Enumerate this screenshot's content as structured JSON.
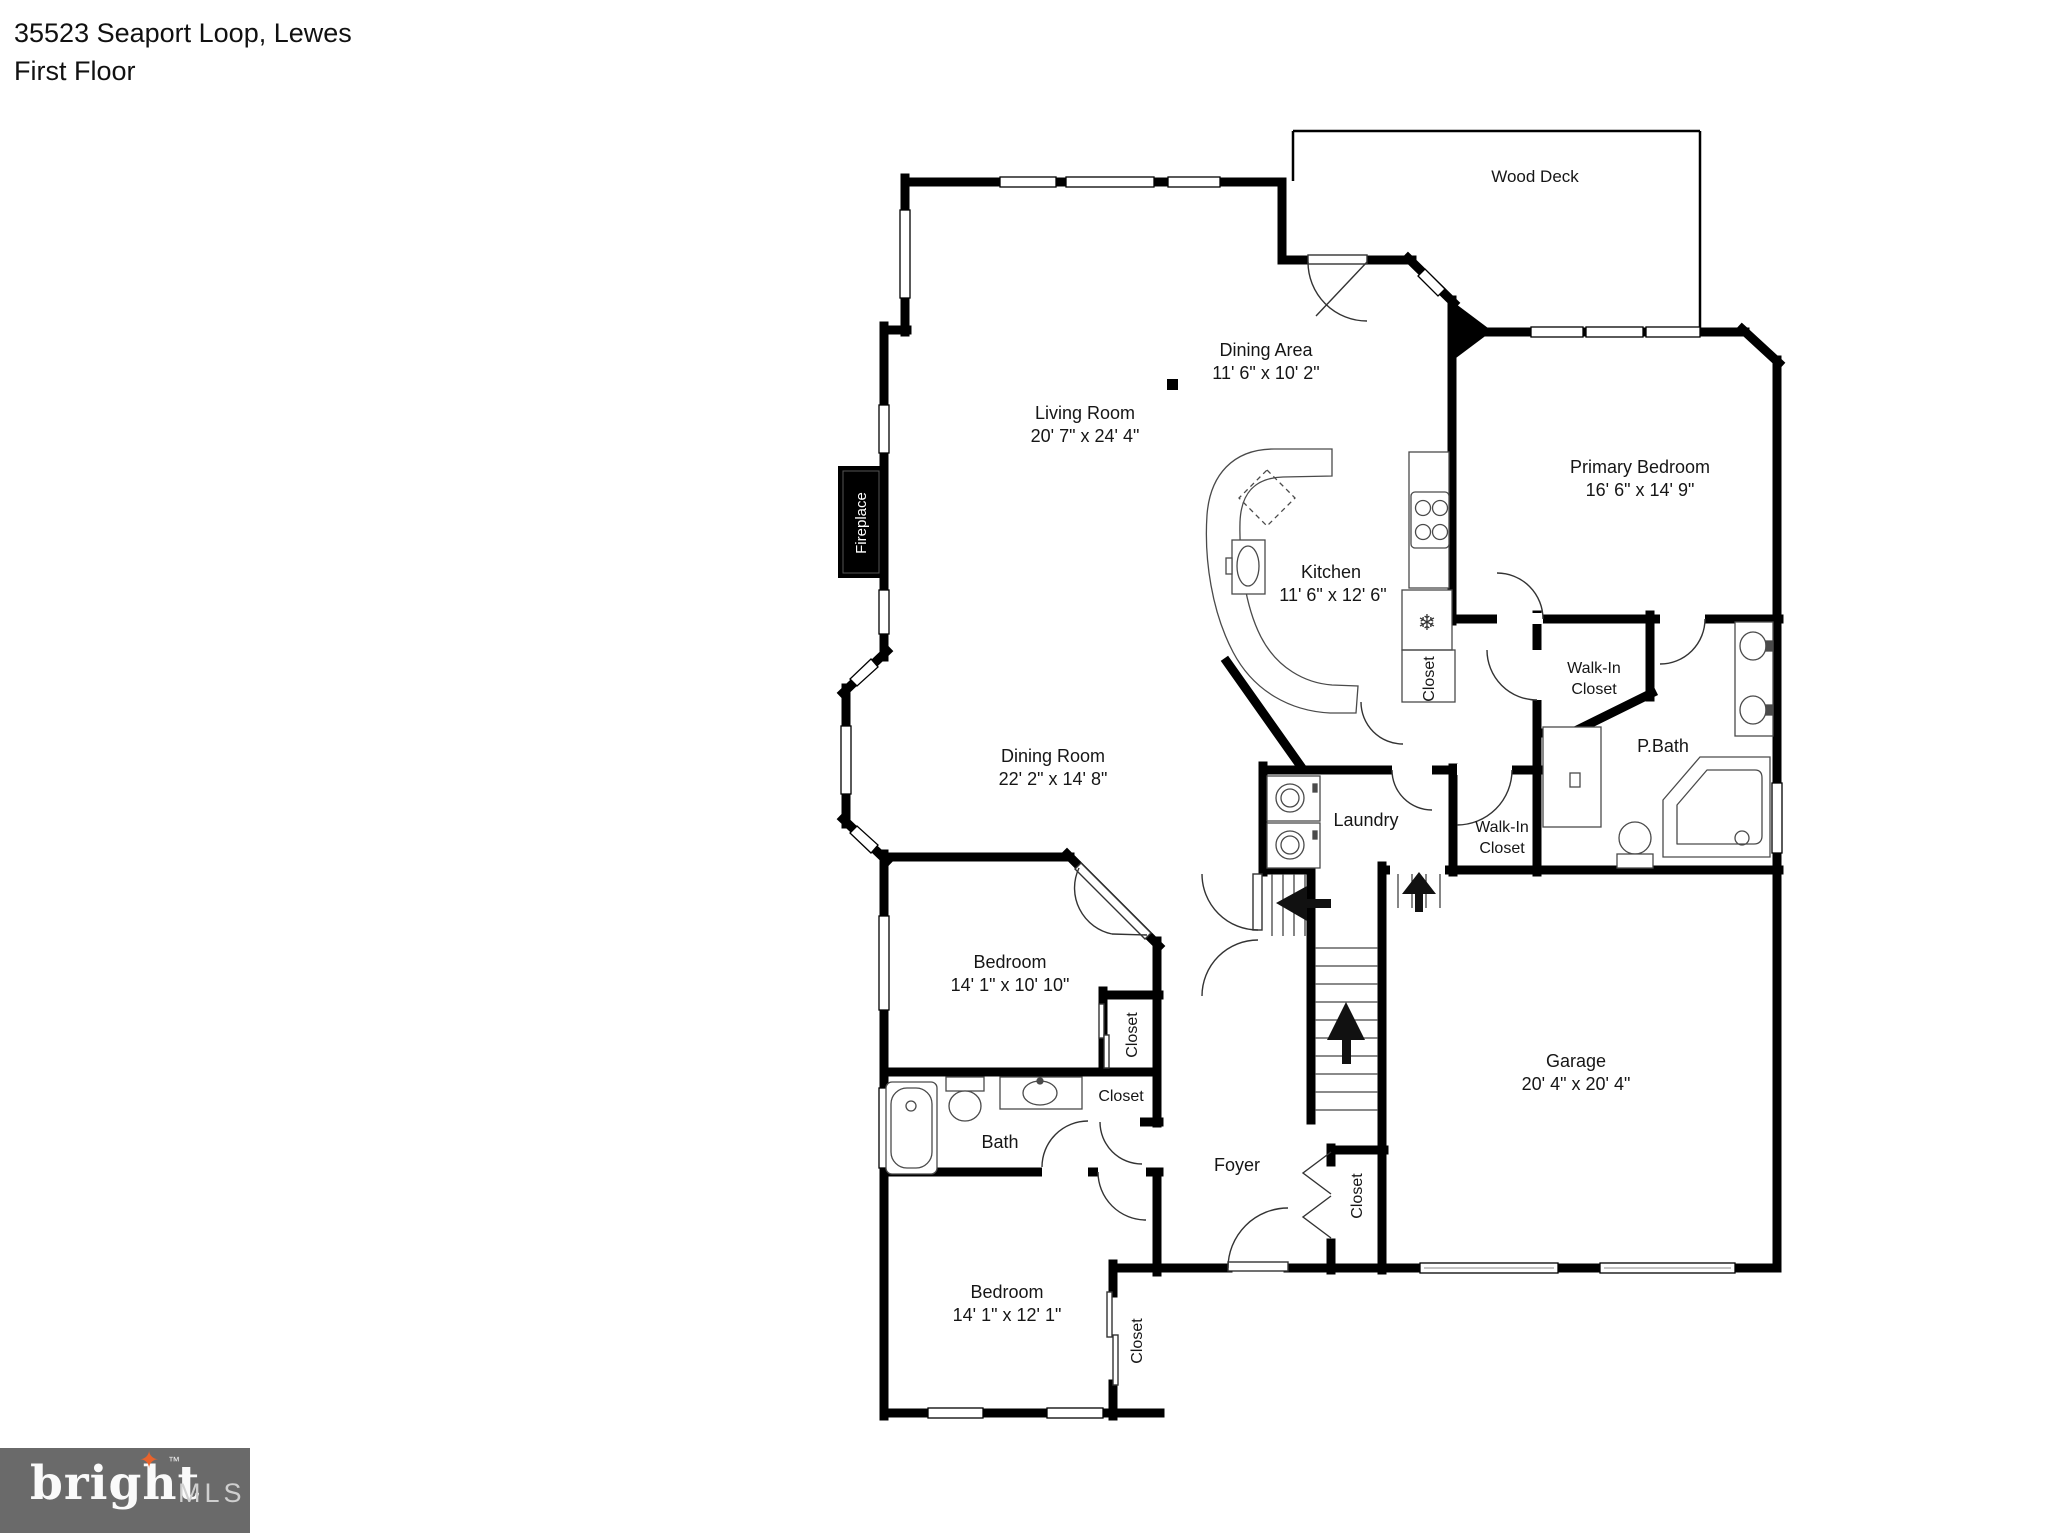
{
  "page": {
    "title_line1": "35523 Seaport Loop, Lewes",
    "title_line2": "First Floor"
  },
  "rooms": {
    "wood_deck": {
      "name": "Wood Deck"
    },
    "dining_area": {
      "name": "Dining Area",
      "dims": "11' 6\" x 10' 2\""
    },
    "living_room": {
      "name": "Living Room",
      "dims": "20' 7\" x 24' 4\""
    },
    "kitchen": {
      "name": "Kitchen",
      "dims": "11' 6\" x 12' 6\""
    },
    "primary_bedroom": {
      "name": "Primary Bedroom",
      "dims": "16' 6\" x 14' 9\""
    },
    "primary_walk_in_closet": {
      "name_line1": "Walk-In",
      "name_line2": "Closet"
    },
    "primary_bath": {
      "name": "P.Bath"
    },
    "laundry": {
      "name": "Laundry"
    },
    "hall_walk_in_closet": {
      "name_line1": "Walk-In",
      "name_line2": "Closet"
    },
    "dining_room": {
      "name": "Dining Room",
      "dims": "22' 2\" x 14' 8\""
    },
    "bedroom_middle": {
      "name": "Bedroom",
      "dims": "14' 1\" x 10' 10\""
    },
    "bath": {
      "name": "Bath"
    },
    "foyer": {
      "name": "Foyer"
    },
    "garage": {
      "name": "Garage",
      "dims": "20' 4\" x 20' 4\""
    },
    "bedroom_front": {
      "name": "Bedroom",
      "dims": "14' 1\" x 12' 1\""
    }
  },
  "labels": {
    "closet": "Closet",
    "fireplace": "Fireplace"
  },
  "icons": {
    "fridge_snowflake": "❄"
  },
  "logo": {
    "brand": "bright",
    "star": "✦",
    "tm": "™",
    "suffix": "MLS"
  },
  "colors": {
    "walls": "#000000",
    "logo_bg": "#6a6a6a",
    "logo_star": "#e8632c",
    "logo_mls": "#cfcfcf"
  }
}
